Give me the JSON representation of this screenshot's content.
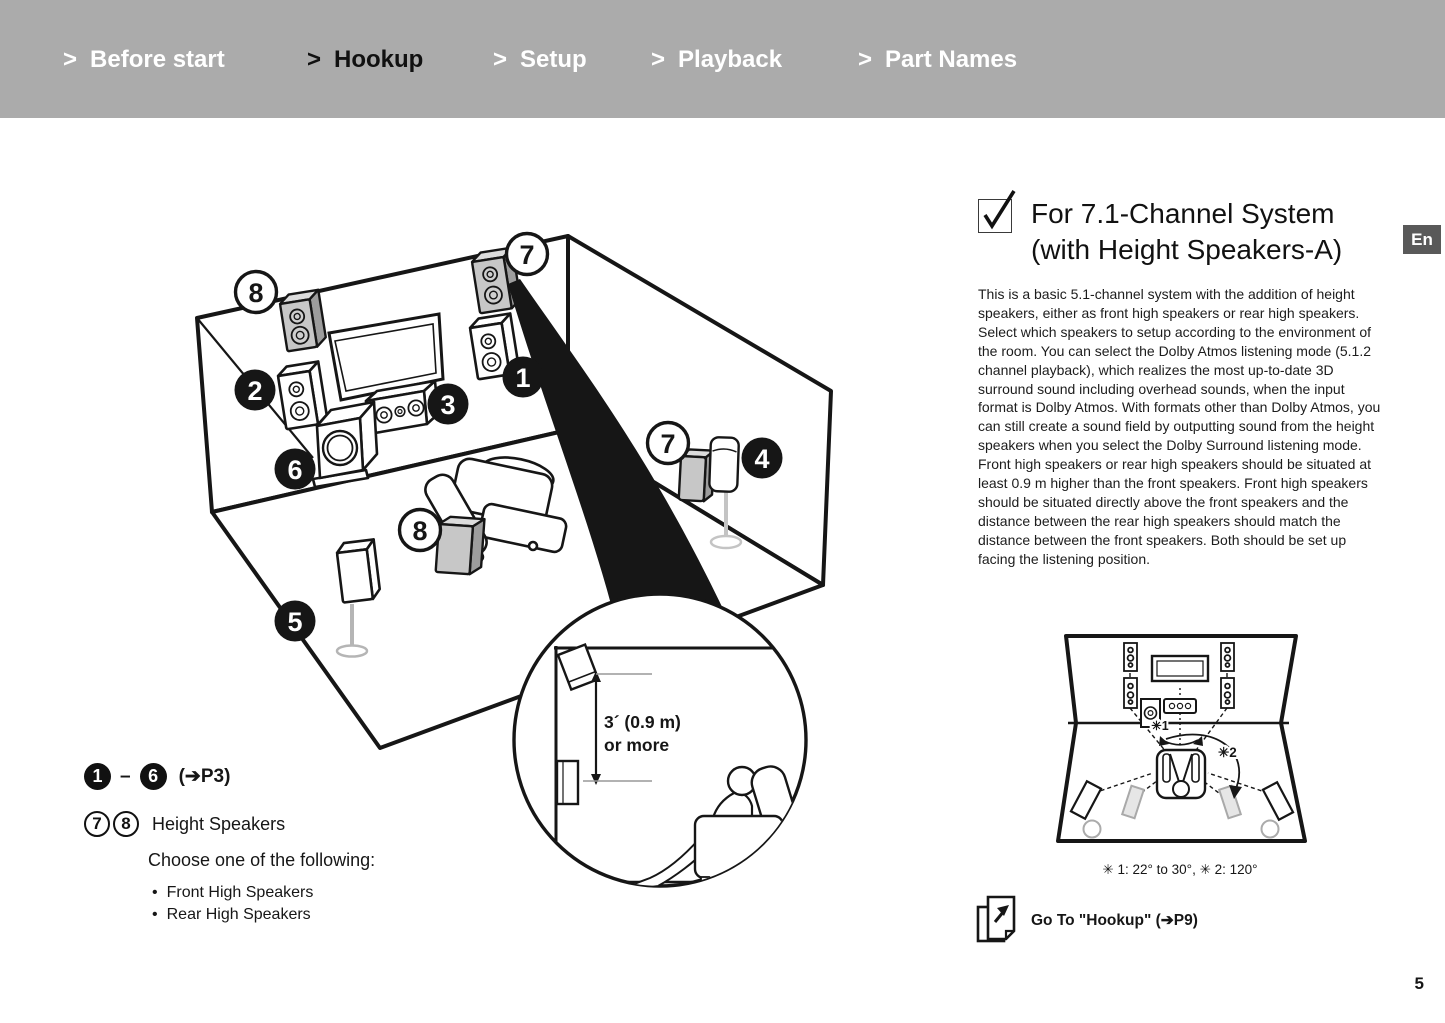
{
  "colors": {
    "header_bg": "#ababab",
    "ink": "#161616",
    "speaker_gray": "#c7c7c7",
    "lang_badge_bg": "#595959"
  },
  "nav": {
    "arrow": ">",
    "items": [
      "Before start",
      "Hookup",
      "Setup",
      "Playback",
      "Part Names"
    ],
    "active_index": 1
  },
  "lang_badge": "En",
  "section": {
    "title_line1": "For 7.1-Channel System",
    "title_line2": "(with Height Speakers-A)",
    "body": "This is a basic 5.1-channel system with the addition of height speakers, either as front high speakers or rear high speakers. Select which speakers to setup according to the environment of the room. You can select the Dolby Atmos listening mode (5.1.2 channel playback), which realizes the most up-to-date 3D surround sound including overhead sounds, when the input format is Dolby Atmos. With formats other than Dolby Atmos, you can still create a sound field by outputting sound from the height speakers when you select the Dolby Surround listening mode. Front high speakers or rear high speakers should be situated at least 0.9 m higher than the front speakers. Front high speakers should be situated directly above the front speakers and the distance between the rear high speakers should match the distance between the front speakers. Both should be set up facing the listening position."
  },
  "legend": {
    "range_start": "1",
    "range_dash": "–",
    "range_end": "6",
    "range_ref": "(➔P3)",
    "height_nums": [
      "7",
      "8"
    ],
    "height_label": "Height Speakers",
    "choose_label": "Choose one of the following:",
    "bullet": "•",
    "options": [
      "Front High Speakers",
      "Rear High Speakers"
    ]
  },
  "diagram": {
    "badges": [
      "8",
      "7",
      "2",
      "1",
      "3",
      "7",
      "4",
      "6",
      "8",
      "5"
    ],
    "inset_line1": "3´ (0.9 m)",
    "inset_line2": "or more"
  },
  "mini": {
    "label1": "✳1",
    "label2": "✳2",
    "caption": "✳ 1: 22° to 30°, ✳ 2: 120°"
  },
  "goto_label": "Go To \"Hookup\" (➔P9)",
  "page_number": "5"
}
